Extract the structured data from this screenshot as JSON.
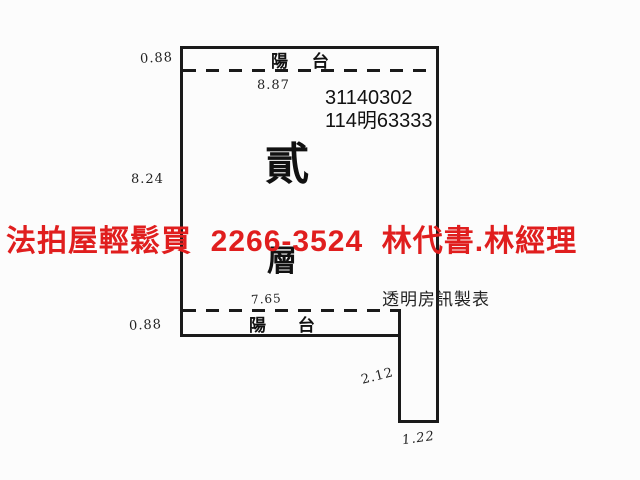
{
  "overlay": {
    "ad_text": "法拍屋輕鬆買  2266-3524  林代書.林經理",
    "color": "#e01e1e"
  },
  "plan": {
    "top_balcony_label": "陽 台",
    "bottom_balcony_label": "陽 台",
    "floor_char_top": "貳",
    "floor_char_bottom": "層",
    "case_no_line1": "31140302",
    "case_no_line2": "114明63333",
    "maker_credit": "透明房訊製表",
    "wall_color": "#1a1a1a",
    "measurements": {
      "top_balcony_depth": "0.88",
      "top_width": "8.87",
      "left_depth": "8.24",
      "bottom_balcony_depth": "0.88",
      "bottom_width": "7.65",
      "extension_depth": "2.12",
      "extension_width": "1.22"
    }
  }
}
